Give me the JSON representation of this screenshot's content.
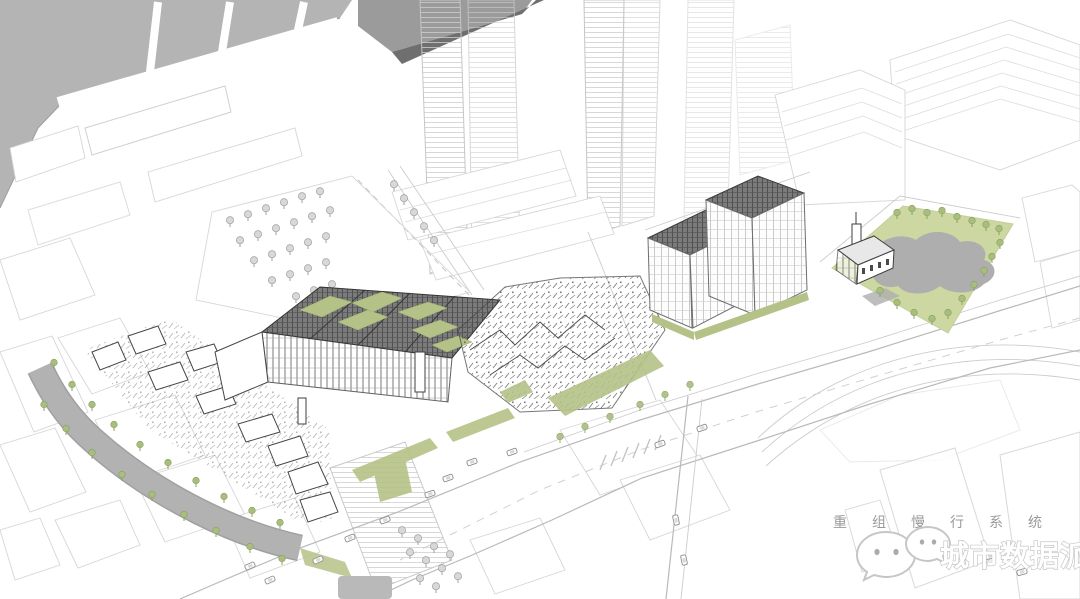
{
  "meta": {
    "description": "Black-and-white axonometric urban design rendering of a waterfront district: grey harbor with piers (top left), background towers, a renovated market complex with roof gardens, historic low-rise clusters, two mansard-roof blocks, a green pocket park with pond (right), and a tree-lined canal (bottom left)."
  },
  "overlay": {
    "annotation_text": "重组慢行系统",
    "watermark_text": "城市数据派",
    "watermark_icon": "wechat-chat-bubbles-icon"
  },
  "colors": {
    "background": "#ffffff",
    "water_grey": "#b4b4b4",
    "shore_edge": "#9d9d9d",
    "context_roof_grey": "#9b9b9b",
    "context_roof_shade": "#6f6f6f",
    "canal_grey": "#b2b2b2",
    "canal_edge": "#a0a0a0",
    "pond_grey": "#aeaeae",
    "park_green": "#ccd7a2",
    "park_edge": "#c2cf97",
    "tree_green": "#a9bd7e",
    "roof_garden_green": "#b5c287",
    "dark_roof_grey": "#7b7b7b",
    "ink_dark": "#3f3f3f",
    "plaza_grey": "#b9b9b9",
    "annotation_grey": "#9a9a9a",
    "watermark_fill": "#ffffff",
    "watermark_outline": "#c6c6c6"
  }
}
